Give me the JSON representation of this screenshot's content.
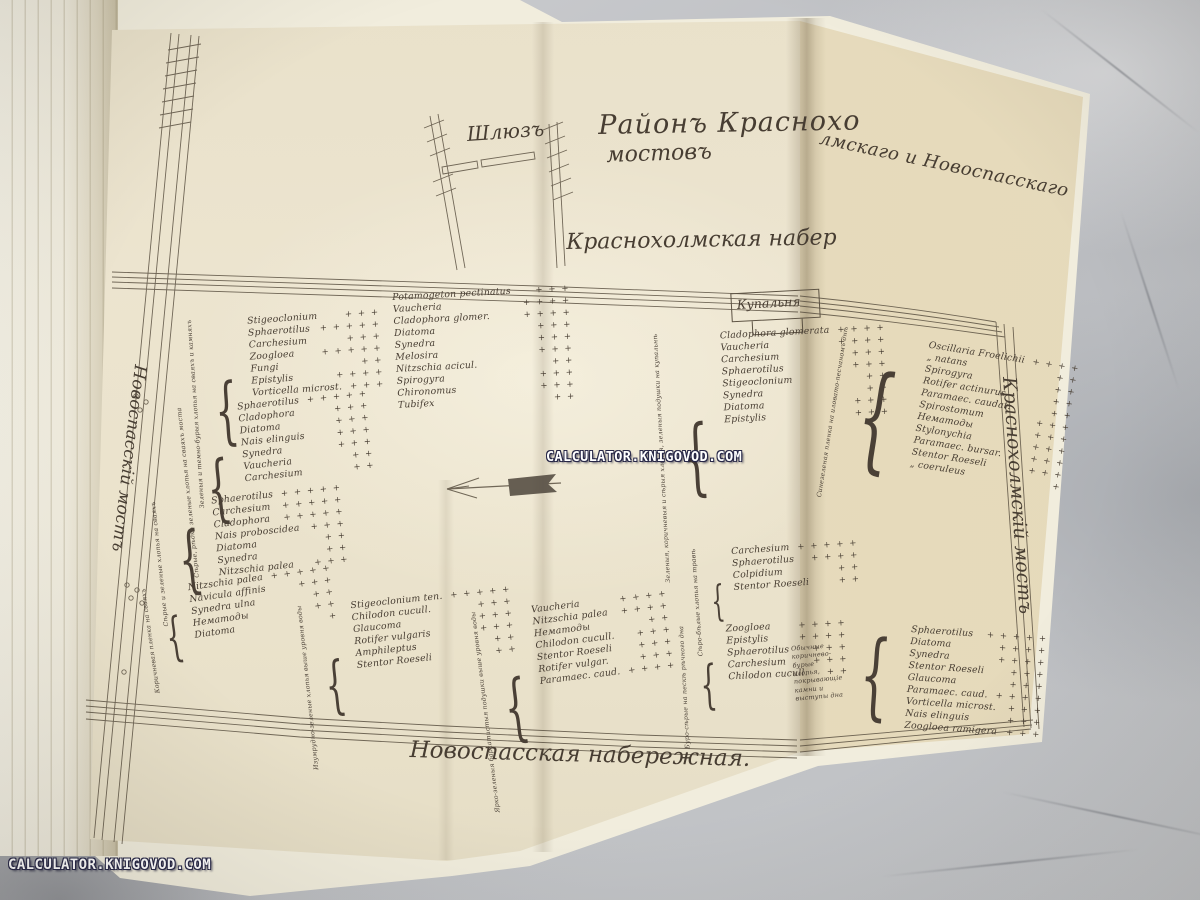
{
  "watermarks": {
    "center": "CALCULATOR.KNIGOVOD.COM",
    "bottom_left": "CALCULATOR.KNIGOVOD.COM"
  },
  "map": {
    "sluice": "Шлюзъ",
    "title_part1": "Районъ Краснохо",
    "title_part2": "лмскаго и Новоспасскаго",
    "title_line2": "мостовъ",
    "embankment_top": "Краснохолмская набер",
    "embankment_bottom": "Новоспасская набережная.",
    "bridge_left": "Новоспасскій мостъ",
    "bridge_right": "Краснохолмскій мостъ",
    "bathhouse": "Купальня",
    "groups": [
      {
        "habitat": "Зеленыя и темно-бурыя хлопья на сваяхъ и камняхъ",
        "species": [
          {
            "name": "Stigeoclonium",
            "marks": "+ + +"
          },
          {
            "name": "Sphaerotilus",
            "marks": "+ + + + +"
          },
          {
            "name": "Carchesium",
            "marks": "+ + +"
          },
          {
            "name": "Zoogloea",
            "marks": "+ + + + +"
          },
          {
            "name": "Fungi",
            "marks": "+ +"
          },
          {
            "name": "Epistylis",
            "marks": "+ + + +"
          },
          {
            "name": "Vorticella microst.",
            "marks": "+ + +"
          }
        ]
      },
      {
        "habitat": "Сѣрые, рѣдко зеленые хлопья на сваяхъ моста",
        "species": [
          {
            "name": "Sphaerotilus",
            "marks": "+ + + + +"
          },
          {
            "name": "Cladophora",
            "marks": "+ + +"
          },
          {
            "name": "Diatoma",
            "marks": "+ + +"
          },
          {
            "name": "Nais elinguis",
            "marks": "+ + +"
          },
          {
            "name": "Synedra",
            "marks": "+ + +"
          },
          {
            "name": "Vaucheria",
            "marks": "+ +"
          },
          {
            "name": "Carchesium",
            "marks": "+ +"
          }
        ]
      },
      {
        "habitat": "Сѣрые и зеленые хлопья на сваяхъ",
        "species": [
          {
            "name": "Sphaerotilus",
            "marks": "+ + + + +"
          },
          {
            "name": "Carchesium",
            "marks": "+ + + + +"
          },
          {
            "name": "Cladophora",
            "marks": "+ + + + +"
          },
          {
            "name": "Nais proboscidea",
            "marks": "+ + +"
          },
          {
            "name": "Diatoma",
            "marks": "+ +"
          },
          {
            "name": "Synedra",
            "marks": "+ +"
          },
          {
            "name": "Nitzschia palea",
            "marks": "+ + +"
          }
        ]
      },
      {
        "habitat": "Коричневая пленка на сваяхъ",
        "species": [
          {
            "name": "Nitzschia palea",
            "marks": "+ + + + +"
          },
          {
            "name": "Navicula affinis",
            "marks": "+ + +"
          },
          {
            "name": "Synedra ulna",
            "marks": "+ +"
          },
          {
            "name": "Нематоды",
            "marks": "+ +"
          },
          {
            "name": "Diatoma",
            "marks": "+"
          }
        ]
      },
      {
        "habitat": "",
        "species": [
          {
            "name": "Potamogeton pectinatus",
            "marks": "+ + +"
          },
          {
            "name": "Vaucheria",
            "marks": "+ + + +"
          },
          {
            "name": "Cladophora glomer.",
            "marks": "+ + + +"
          },
          {
            "name": "Diatoma",
            "marks": "+ + +"
          },
          {
            "name": "Synedra",
            "marks": "+ + +"
          },
          {
            "name": "Melosira",
            "marks": "+ + +"
          },
          {
            "name": "Nitzschia acicul.",
            "marks": "+ +"
          },
          {
            "name": "Spirogyra",
            "marks": "+ + +"
          },
          {
            "name": "Chironomus",
            "marks": "+ + +"
          },
          {
            "name": "Tubifex",
            "marks": "+ +"
          }
        ]
      },
      {
        "habitat": "Зеленыя, коричневыя и сѣрыя хлопья, зеленыя подушки на купальнѣ",
        "species": [
          {
            "name": "Cladophora glomerata",
            "marks": "+ + + +"
          },
          {
            "name": "Vaucheria",
            "marks": "+ + + +"
          },
          {
            "name": "Carchesium",
            "marks": "+ + +"
          },
          {
            "name": "Sphaerotilus",
            "marks": "+ + +"
          },
          {
            "name": "Stigeoclonium",
            "marks": "+ +"
          },
          {
            "name": "Synedra",
            "marks": "+ +"
          },
          {
            "name": "Diatoma",
            "marks": "+ + +"
          },
          {
            "name": "Epistylis",
            "marks": "+ + +"
          }
        ]
      },
      {
        "habitat": "Синезеленая пленка на иловато-песчаномъ днѣ",
        "species": [
          {
            "name": "Oscillaria Froelichii",
            "marks": "+ + + +"
          },
          {
            "name": "„  natans",
            "marks": "+ +"
          },
          {
            "name": "Spirogyra",
            "marks": "+ +"
          },
          {
            "name": "Rotifer actinurus",
            "marks": "+ +"
          },
          {
            "name": "Paramaec. caudat.",
            "marks": "+ +"
          },
          {
            "name": "Spirostomum",
            "marks": "+ + +"
          },
          {
            "name": "Нематоды",
            "marks": "+ + +"
          },
          {
            "name": "Stylonychia",
            "marks": "+ + +"
          },
          {
            "name": "Paramaec. bursar.",
            "marks": "+ + +"
          },
          {
            "name": "Stentor Roeseli",
            "marks": "+ + +"
          },
          {
            "name": "„  coeruleus",
            "marks": "+"
          }
        ]
      },
      {
        "habitat": "Изумрудно-зеленые хлопья выше уровня воды",
        "species": [
          {
            "name": "Stigeoclonium ten.",
            "marks": "+ + + + +"
          },
          {
            "name": "Chilodon cucull.",
            "marks": "+ + +"
          },
          {
            "name": "Glaucoma",
            "marks": "+ + +"
          },
          {
            "name": "Rotifer vulgaris",
            "marks": "+ + +"
          },
          {
            "name": "Amphileptus",
            "marks": "+ +"
          },
          {
            "name": "Stentor Roeseli",
            "marks": "+ +"
          }
        ]
      },
      {
        "habitat": "Ярко-зеленыя бархатистыя подушки выше уровня воды",
        "species": [
          {
            "name": "Vaucheria",
            "marks": "+ + + +"
          },
          {
            "name": "Nitzschia palea",
            "marks": "+ + + +"
          },
          {
            "name": "Нематоды",
            "marks": "+ +"
          },
          {
            "name": "Chilodon cucull.",
            "marks": "+ + +"
          },
          {
            "name": "Stentor Roeseli",
            "marks": "+ + +"
          },
          {
            "name": "Rotifer vulgar.",
            "marks": "+ + +"
          },
          {
            "name": "Paramaec. caud.",
            "marks": "+ + + +"
          }
        ]
      },
      {
        "habitat": "Сѣро-бѣлые хлопья на травѣ",
        "species": [
          {
            "name": "Carchesium",
            "marks": "+ + + + +"
          },
          {
            "name": "Sphaerotilus",
            "marks": "+ + + +"
          },
          {
            "name": "Colpidium",
            "marks": "+ +"
          },
          {
            "name": "Stentor Roeseli",
            "marks": "+ +"
          }
        ]
      },
      {
        "habitat": "Буро-сѣрые на пескѣ рѣчного дна",
        "species": [
          {
            "name": "Zoogloea",
            "marks": "+ + + +"
          },
          {
            "name": "Epistylis",
            "marks": "+ + + +"
          },
          {
            "name": "Sphaerotilus",
            "marks": "+ + +"
          },
          {
            "name": "Carchesium",
            "marks": "+ + +"
          },
          {
            "name": "Chilodon cucull.",
            "marks": "+ +"
          }
        ]
      },
      {
        "habitat": "Обычные коричнево-бурые хлопья, покрывающіе камни и выступы дна",
        "species": [
          {
            "name": "Sphaerotilus",
            "marks": "+ + + + +"
          },
          {
            "name": "Diatoma",
            "marks": "+ + + +"
          },
          {
            "name": "Synedra",
            "marks": "+ + + +"
          },
          {
            "name": "Stentor Roeseli",
            "marks": "+ + +"
          },
          {
            "name": "Glaucoma",
            "marks": "+ + +"
          },
          {
            "name": "Paramaec. caud.",
            "marks": "+ + + +"
          },
          {
            "name": "Vorticella microst.",
            "marks": "+ + +"
          },
          {
            "name": "Nais elinguis",
            "marks": "+ + +"
          },
          {
            "name": "Zoogloea ramigera",
            "marks": "+ + +"
          }
        ]
      }
    ]
  }
}
